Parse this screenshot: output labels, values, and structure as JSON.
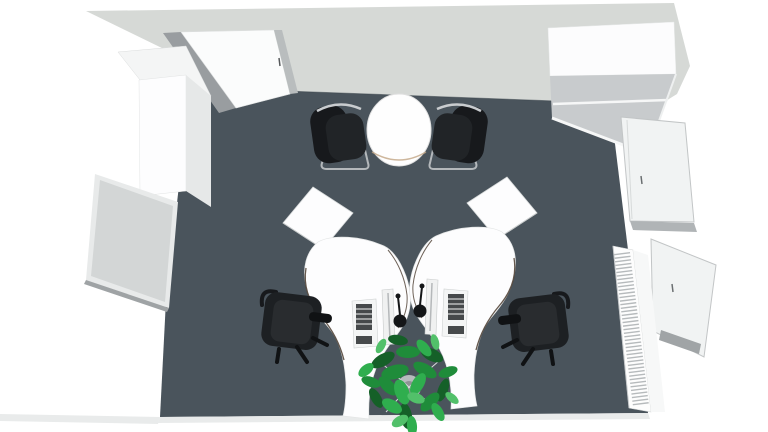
{
  "scene": {
    "view": "top-down-3d-room-render",
    "objects": {
      "door": "entry door (open)",
      "wardrobe": "tall cabinet",
      "whiteboard": "wall whiteboard",
      "meeting_table": "round table",
      "visitor_chair_left": "cantilever chair",
      "visitor_chair_right": "cantilever chair",
      "sideboard": "sideboard cabinet",
      "window_upper": "window",
      "window_lower": "window",
      "radiator": "radiator",
      "desk_left": "curved desk",
      "desk_right": "curved desk",
      "task_chair_left": "office chair",
      "task_chair_right": "office chair",
      "monitor": "monitor",
      "keyboard": "keyboard",
      "desk_lamp": "desk lamp",
      "plant": "potted plant"
    }
  },
  "colors": {
    "background": "#ffffff",
    "wall_band": "#d6d9d6",
    "wall_base_line": "#39434a",
    "floor": "#4a545c",
    "door_panel": "#fbfcfc",
    "door_jamb": "#999da0",
    "door_jamb_light": "#b9bdbe",
    "wardrobe_top": "#f4f5f5",
    "wardrobe_front": "#fdfdfe",
    "wardrobe_side": "#e6e8e8",
    "whiteboard_frame": "#e8eaea",
    "whiteboard_panel": "#d3d6d6",
    "whiteboard_edge": "#9fa3a5",
    "cabinet_back": "#fcfcfd",
    "cabinet_top": "#c8cbcd",
    "cabinet_seam": "#f6f7f7",
    "window_glass": "#f1f3f3",
    "window_frame": "#c2c5c6",
    "window_sill": "#a0a4a6",
    "radiator_body": "#fdfdfd",
    "radiator_fin": "#b6babc",
    "table_top": "#fefefe",
    "table_rim": "#c2a584",
    "chrome": "#b4b8bb",
    "chair_shell": "#17191c",
    "chair_seat": "#212427",
    "office_chair": "#1d2023",
    "office_chair_seat": "#292c2f",
    "office_chair_dark": "#101214",
    "desk_top": "#fdfdfe",
    "desk_edge": "#4a3b2e",
    "monitor_body": "#f0f1f1",
    "keyboard_body": "#f4f5f5",
    "keyboard_keys": "#46494b",
    "lamp": "#141618",
    "plant_dark": "#156028",
    "plant_mid": "#1f8c3a",
    "plant_bright": "#2fae4e",
    "plant_light": "#52c06a",
    "pot": "#b7bbbd",
    "pot_inner": "#8e9294",
    "shadow": "#e9ebeb"
  }
}
